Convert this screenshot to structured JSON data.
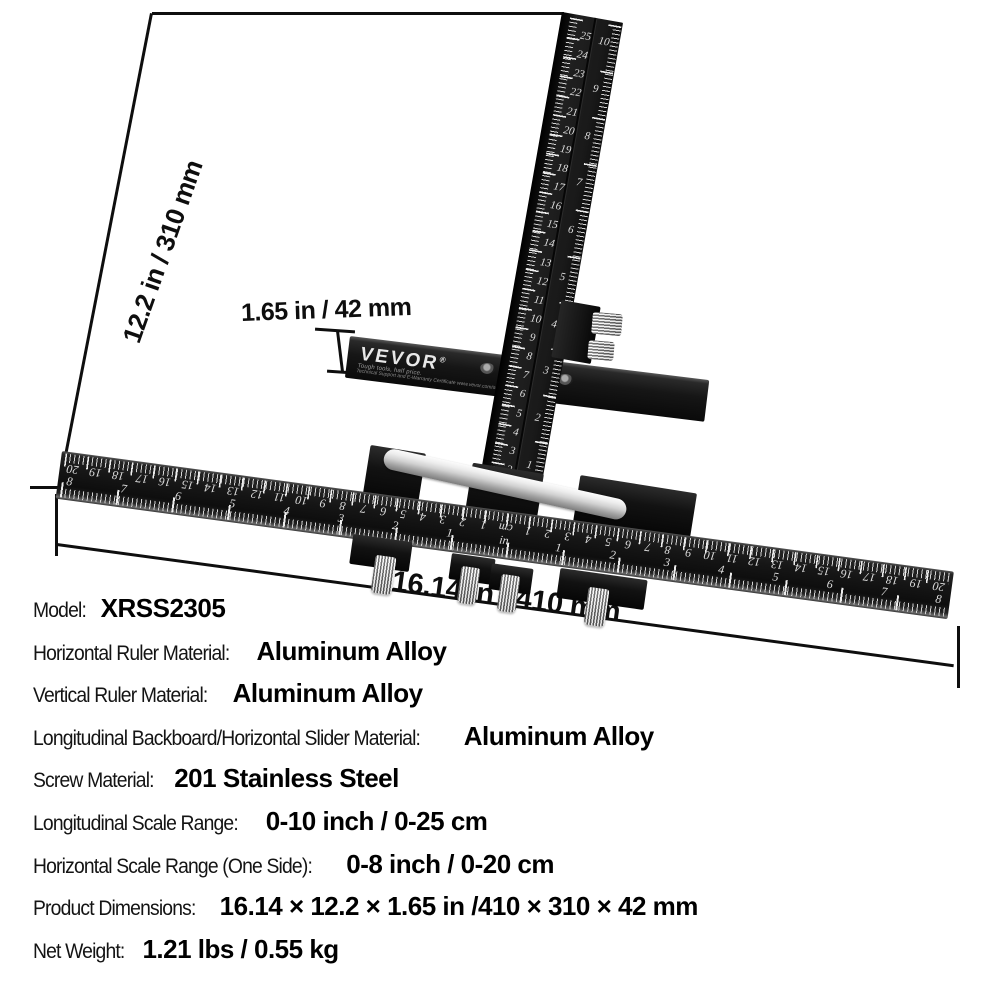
{
  "product": {
    "brand": "VEVOR",
    "brand_registered": "®",
    "brand_tagline": "Tough tools, half price.",
    "brand_support": "Technical Support and E-Warranty Certificate www.vevor.com/support"
  },
  "annotations": {
    "height": "12.2 in / 310 mm",
    "thickness": "1.65 in / 42 mm",
    "width": "16.14 in / 410 mm"
  },
  "vertical_ruler": {
    "cm_numbers": [
      "25",
      "24",
      "23",
      "22",
      "21",
      "20",
      "19",
      "18",
      "17",
      "16",
      "15",
      "14",
      "13",
      "12",
      "11",
      "10",
      "9",
      "8",
      "7",
      "6",
      "5",
      "4",
      "3",
      "2"
    ],
    "inch_numbers": [
      "10",
      "9",
      "8",
      "7",
      "6",
      "5",
      "4",
      "3",
      "2",
      "1"
    ]
  },
  "horizontal_ruler": {
    "cm_row": [
      "20",
      "19",
      "18",
      "17",
      "16",
      "15",
      "14",
      "13",
      "12",
      "11",
      "10",
      "9",
      "8",
      "7",
      "6",
      "5",
      "4",
      "3",
      "2",
      "1",
      "cm",
      "1",
      "2",
      "3",
      "4",
      "5",
      "6",
      "7",
      "8",
      "9",
      "10",
      "11",
      "12",
      "13",
      "14",
      "15",
      "16",
      "17",
      "18",
      "19",
      "20"
    ],
    "inch_row": [
      "8",
      "7",
      "6",
      "5",
      "4",
      "3",
      "2",
      "1",
      "in",
      "1",
      "2",
      "3",
      "4",
      "5",
      "6",
      "7",
      "8"
    ]
  },
  "specs": [
    {
      "label": "Model:",
      "value": "XRSS2305"
    },
    {
      "label": "Horizontal Ruler Material:",
      "value": "Aluminum Alloy"
    },
    {
      "label": "Vertical Ruler Material:",
      "value": "Aluminum Alloy"
    },
    {
      "label": "Longitudinal Backboard/Horizontal Slider Material:",
      "value": "Aluminum Alloy"
    },
    {
      "label": "Screw Material:",
      "value": "201 Stainless Steel"
    },
    {
      "label": "Longitudinal Scale Range:",
      "value": "0-10 inch / 0-25 cm"
    },
    {
      "label": "Horizontal Scale Range (One Side):",
      "value": "0-8 inch / 0-20 cm"
    },
    {
      "label": "Product Dimensions:",
      "value": "16.14 × 12.2 × 1.65 in /410 × 310 × 42 mm"
    },
    {
      "label": "Net Weight:",
      "value": "1.21 lbs / 0.55 kg"
    }
  ],
  "colors": {
    "background": "#ffffff",
    "ruler_black": "#161616",
    "scale_marks": "#dedede",
    "rail_silver": "#d2d2d2",
    "screw_silver": "#c9c9c9",
    "annotation_text": "#0e0e0e"
  }
}
